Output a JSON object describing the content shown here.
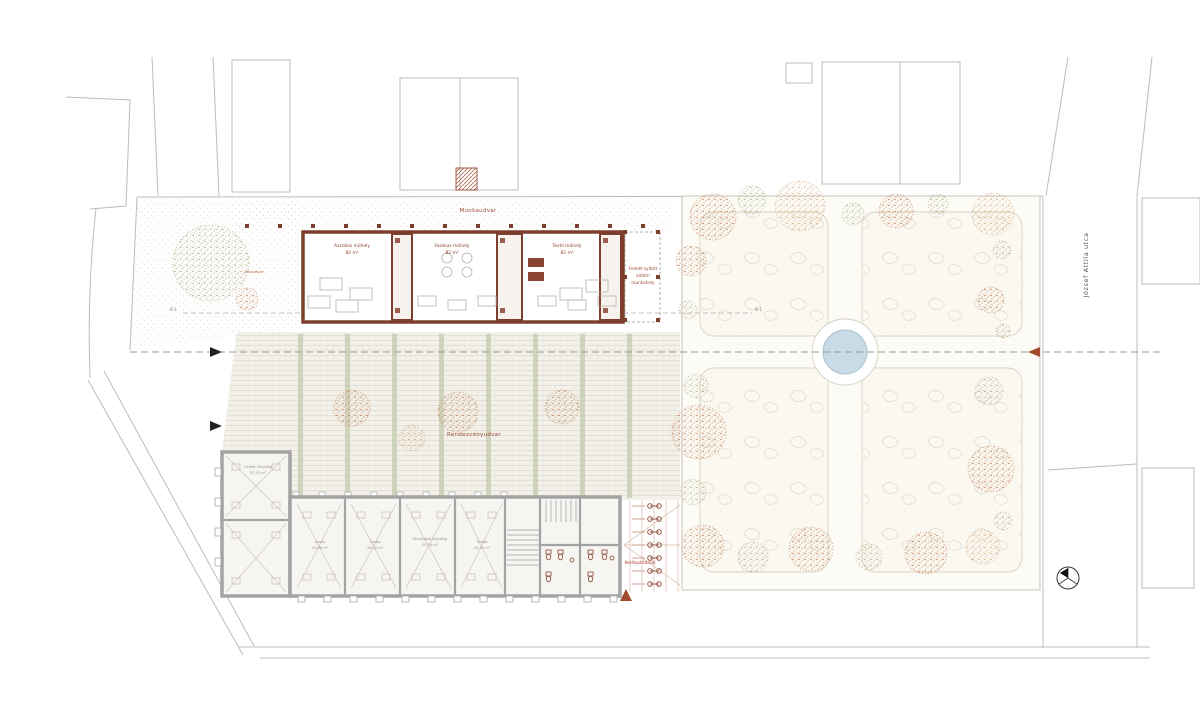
{
  "labels": {
    "munkaudvar": "Munkaudvar",
    "rendezvenyudvar": "Rendezvényudvar",
    "left_yard": "Díszudvar",
    "street_name": "József Attila utca",
    "bike_storage": "Kerékpártároló",
    "section_marker_left": "B-1",
    "section_marker_right": "B-1",
    "covered_area_lines": [
      "Fedett-nyitott",
      "kültéri",
      "munkahely"
    ]
  },
  "workshop_building": {
    "rooms": [
      {
        "name": "Asztalos műhely",
        "area": "82 m²"
      },
      {
        "name": "Fazekas műhely",
        "area": "82 m²"
      },
      {
        "name": "Textil műhely",
        "area": "82 m²"
      }
    ]
  },
  "lower_building": {
    "rooms": [
      {
        "name": "Fedett helyiség",
        "area": "57,55 m²"
      },
      {
        "name": "Szoba",
        "area": "34,66 m²"
      },
      {
        "name": "Szoba",
        "area": "34,32 m²"
      },
      {
        "name": "Kiszolgáló helyiség",
        "area": "29,76 m²"
      },
      {
        "name": "Szoba",
        "area": "25,41 m²"
      }
    ]
  },
  "colors": {
    "wall_brown": "#7c3f2d",
    "accent_red": "#a34a2e",
    "tree_orange": "#c0784e",
    "tree_tan": "#d2a274",
    "tree_olive": "#a8a77e",
    "pond_blue": "#c9dbe6",
    "context_grey": "#bcbcbc"
  }
}
